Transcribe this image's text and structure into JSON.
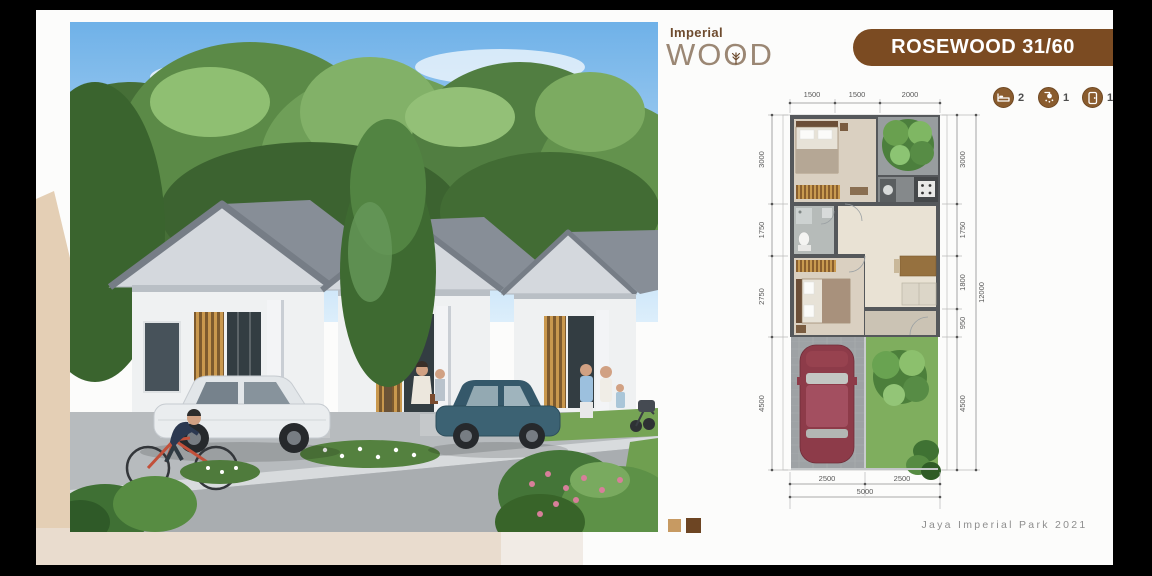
{
  "logo": {
    "imperial": "Imperial",
    "wood_pre": "WO",
    "wood_tree_o": "O",
    "wood_post": "D"
  },
  "banner": {
    "label": "ROSEWOOD 31/60"
  },
  "spec_icons": [
    {
      "name": "bedrooms",
      "count": "2"
    },
    {
      "name": "bathrooms",
      "count": "1"
    },
    {
      "name": "carport",
      "count": "1"
    }
  ],
  "floor_plan": {
    "dims_top": [
      "1500",
      "1500",
      "2000"
    ],
    "dims_left": [
      "3000",
      "1750",
      "2750",
      "4500"
    ],
    "dims_right": [
      "3000",
      "1750",
      "1800",
      "950",
      "4500"
    ],
    "overall_right": "12000",
    "dims_bottom": [
      "2500",
      "2500"
    ],
    "overall_bottom": "5000"
  },
  "footer": {
    "credit": "Jaya Imperial Park 2021"
  },
  "colors": {
    "banner_bg": "#7b4b22",
    "swatch_light": "#c79a62",
    "swatch_dark": "#6d4523"
  }
}
